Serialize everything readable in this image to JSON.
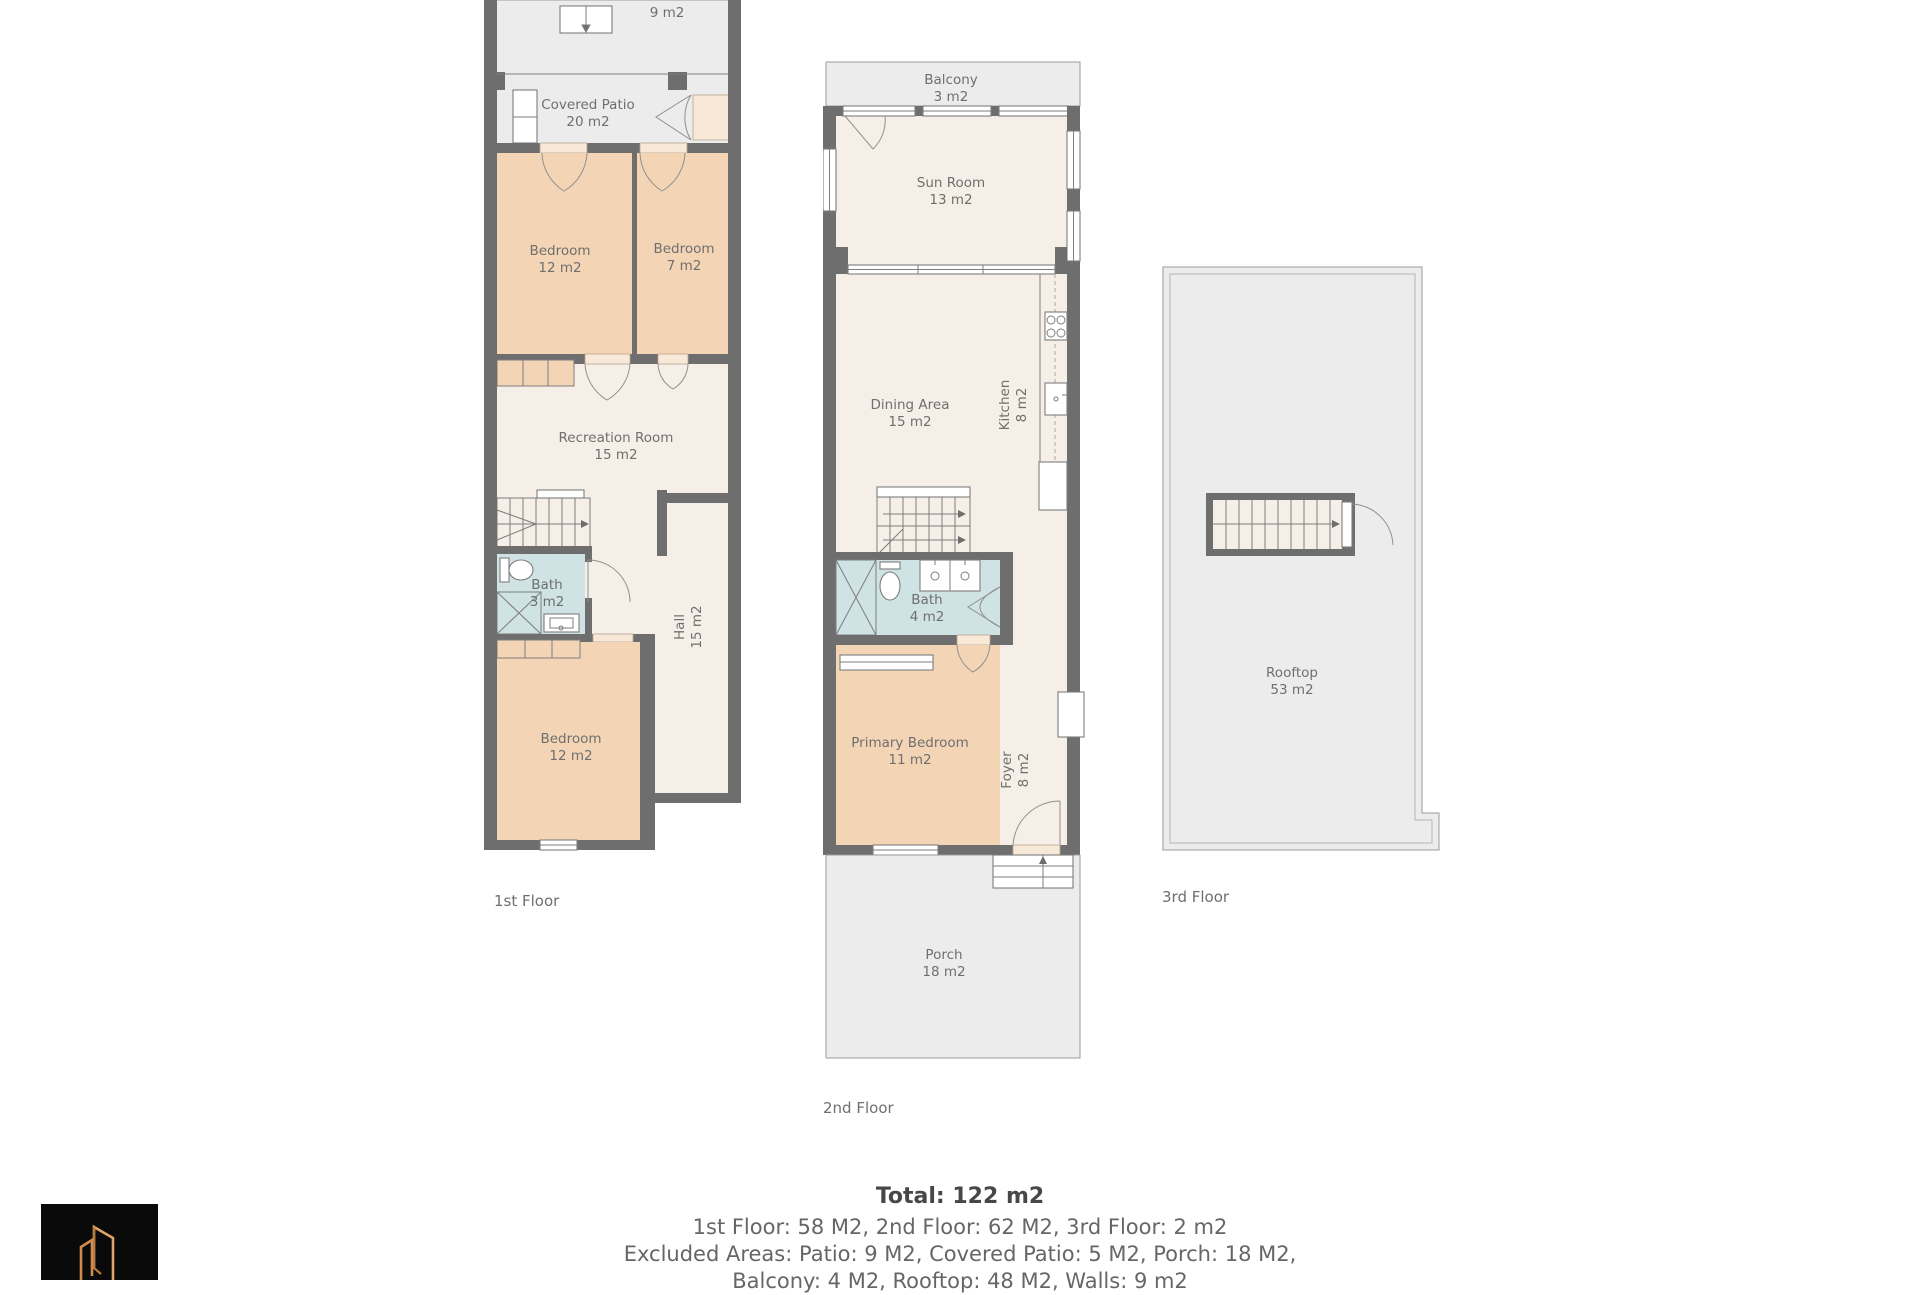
{
  "colors": {
    "wall": "#6e6e6e",
    "floor": "#f6efe8",
    "bedroom": "#f3d5b5",
    "bath": "#cfe2e4",
    "outdoor": "#ececec",
    "logo_accent": "#cf8c4e",
    "label_text": "#6f6f6f"
  },
  "floors": [
    {
      "label": "1st Floor",
      "rooms": [
        {
          "name": "Patio",
          "area": "9 m2"
        },
        {
          "name": "Covered Patio",
          "area": "20 m2"
        },
        {
          "name": "Bedroom",
          "area": "12 m2"
        },
        {
          "name": "Bedroom",
          "area": "7 m2"
        },
        {
          "name": "Recreation Room",
          "area": "15 m2"
        },
        {
          "name": "Bath",
          "area": "3 m2"
        },
        {
          "name": "Hall",
          "area": "15 m2"
        },
        {
          "name": "Bedroom",
          "area": "12 m2"
        }
      ]
    },
    {
      "label": "2nd Floor",
      "rooms": [
        {
          "name": "Balcony",
          "area": "3 m2"
        },
        {
          "name": "Sun Room",
          "area": "13 m2"
        },
        {
          "name": "Dining Area",
          "area": "15 m2"
        },
        {
          "name": "Kitchen",
          "area": "8 m2"
        },
        {
          "name": "Bath",
          "area": "4 m2"
        },
        {
          "name": "Primary Bedroom",
          "area": "11 m2"
        },
        {
          "name": "Foyer",
          "area": "8 m2"
        },
        {
          "name": "Porch",
          "area": "18 m2"
        }
      ]
    },
    {
      "label": "3rd Floor",
      "rooms": [
        {
          "name": "Rooftop",
          "area": "53 m2"
        }
      ]
    }
  ],
  "summary": {
    "total": "Total: 122 m2",
    "line1": "1st Floor: 58 M2, 2nd Floor: 62 M2, 3rd Floor: 2 m2",
    "line2": "Excluded Areas: Patio: 9 M2, Covered Patio: 5 M2, Porch: 18 M2,",
    "line3": "Balcony: 4 M2, Rooftop: 48 M2, Walls: 9 m2"
  }
}
